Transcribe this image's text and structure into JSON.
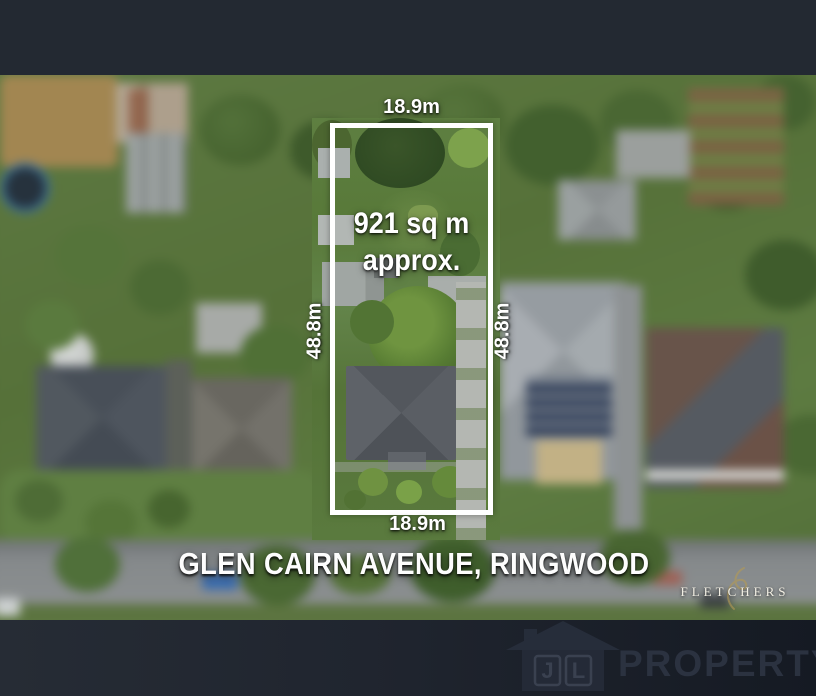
{
  "overlay": {
    "frontage_top": "18.9m",
    "frontage_bottom": "18.9m",
    "depth_left": "48.8m",
    "depth_right": "48.8m",
    "area_line1": "921 sq m",
    "area_line2": "approx.",
    "address": "GLEN CAIRN AVENUE, RINGWOOD"
  },
  "branding": {
    "agency_name": "FLETCHERS",
    "watermark_name": "PROPERTY",
    "monogram_letter_1": "J",
    "monogram_letter_2": "L"
  },
  "colors": {
    "boundary_line": "#ffffff",
    "label_text": "#ffffff",
    "top_bar": "#232932",
    "bottom_bar_left": "#262c35",
    "bottom_bar_right": "#151a23",
    "agency_text": "#f1eee3",
    "agency_flourish": "#b49a55",
    "watermark_text": "#2b3240"
  }
}
